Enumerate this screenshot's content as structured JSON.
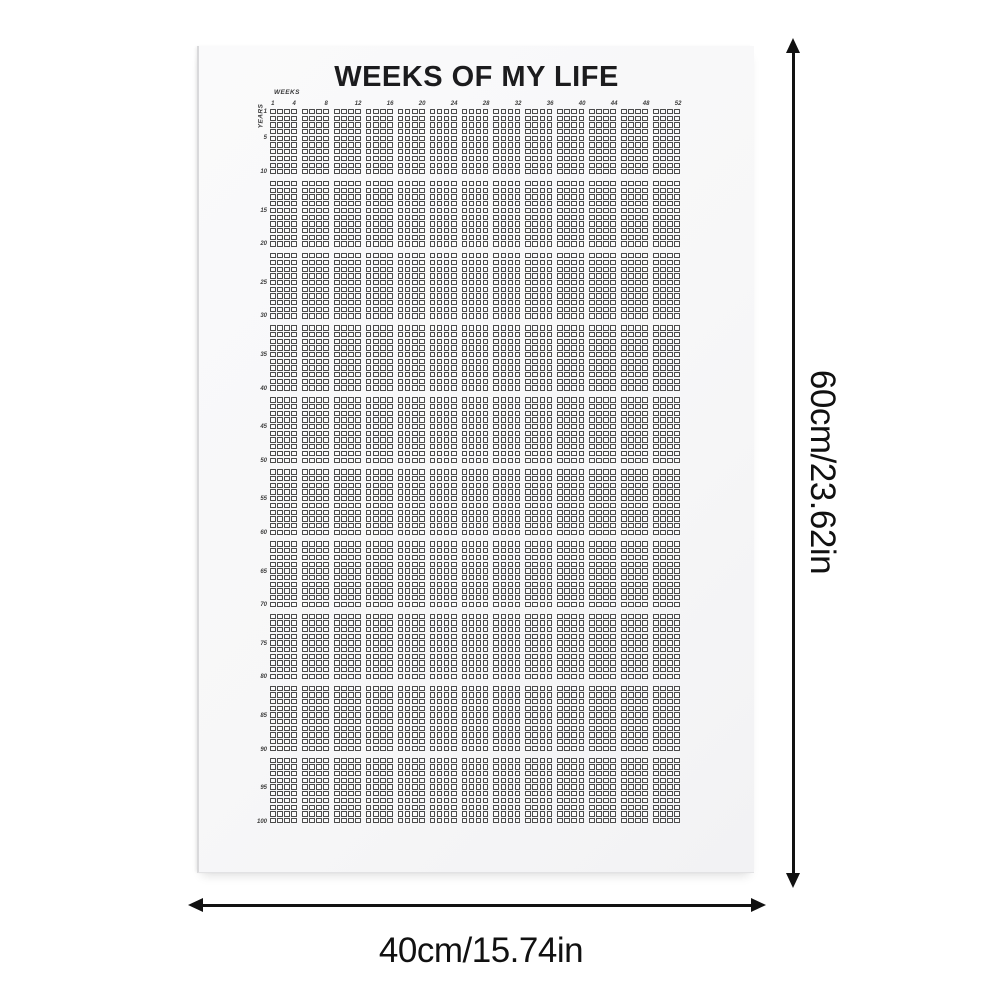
{
  "poster": {
    "title": "WEEKS OF MY LIFE",
    "weeks_axis_label": "WEEKS",
    "years_axis_label": "YEARS",
    "week_tick_labels": [
      1,
      4,
      8,
      12,
      16,
      20,
      24,
      28,
      32,
      36,
      40,
      44,
      48,
      52
    ],
    "year_tick_labels": [
      1,
      5,
      10,
      15,
      20,
      25,
      30,
      35,
      40,
      45,
      50,
      55,
      60,
      65,
      70,
      75,
      80,
      85,
      90,
      95,
      100
    ],
    "grid": {
      "weeks_per_year": 52,
      "total_years": 100,
      "weeks_per_block": 4,
      "years_per_band": 10,
      "column_blocks": 13,
      "row_bands": 10
    }
  },
  "dimensions": {
    "height_label": "60cm/23.62in",
    "width_label": "40cm/15.74in"
  },
  "colors": {
    "poster_bg": "#f7f7f8",
    "grid_line": "#4a4a4a",
    "cell_fill": "#fafafa",
    "title_color": "#1c1c1e",
    "annotation_color": "#111111"
  }
}
